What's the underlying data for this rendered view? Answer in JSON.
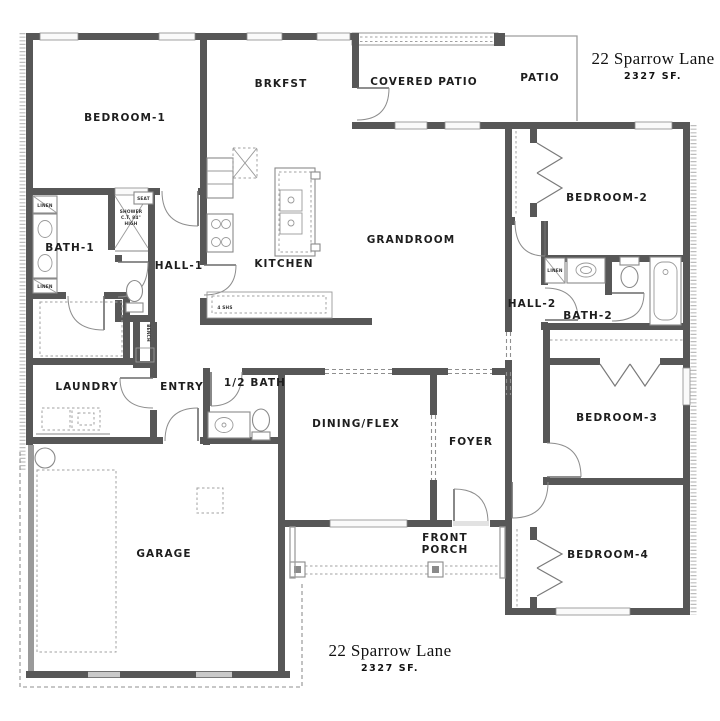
{
  "title": {
    "address": "22 Sparrow Lane",
    "area": "2327 SF."
  },
  "rooms": {
    "bedroom1": "BEDROOM-1",
    "brkfst": "BRKFST",
    "covered_patio": "COVERED PATIO",
    "patio": "PATIO",
    "bedroom2": "BEDROOM-2",
    "grandroom": "GRANDROOM",
    "kitchen": "KITCHEN",
    "bath1": "BATH-1",
    "hall1": "HALL-1",
    "hall2": "HALL-2",
    "bath2": "BATH-2",
    "bedroom3": "BEDROOM-3",
    "laundry": "LAUNDRY",
    "entry": "ENTRY",
    "half_bath": "1/2 BATH",
    "dining": "DINING/FLEX",
    "foyer": "FOYER",
    "front_porch_line1": "FRONT",
    "front_porch_line2": "PORCH",
    "garage": "GARAGE",
    "bedroom4": "BEDROOM-4"
  },
  "annotations": {
    "linen": "LINEN",
    "seat": "SEAT",
    "shower_line1": "SHOWER",
    "shower_line2": "C.T. 84\"",
    "shower_line3": "HIGH",
    "bench": "BENCH",
    "pantry_shelves": "4 SHS"
  },
  "colors": {
    "background": "#ffffff",
    "wall": "#575757",
    "wall_light": "#9a9a9a",
    "text": "#1e1e1e",
    "fixture_line": "#8a8a8a"
  }
}
